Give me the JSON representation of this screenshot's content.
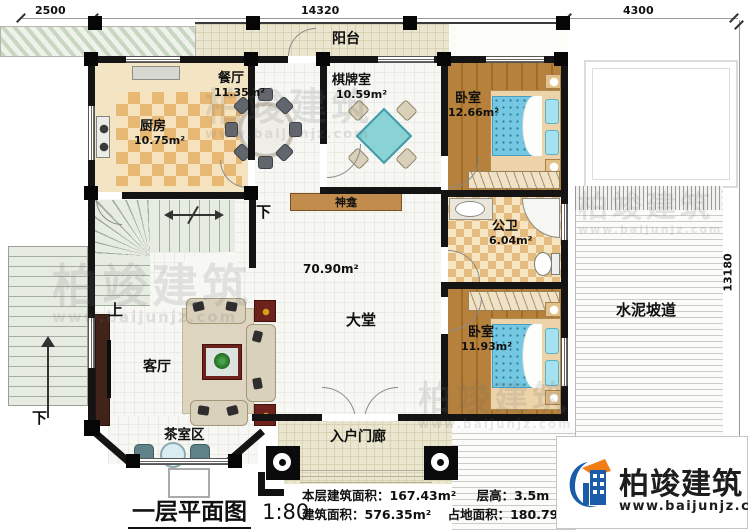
{
  "title_block": {
    "title": "一层平面图",
    "scale": "1:80"
  },
  "stats": {
    "floor_area": "本层建筑面积：167.43m²",
    "floor_height": "层高：3.5m",
    "total_area": "建筑面积：576.35m²",
    "footprint": "占地面积：180.79m²"
  },
  "dimensions": {
    "top_left": "2500",
    "top_middle": "14320",
    "top_right": "4300",
    "right_side": "13180"
  },
  "rooms": {
    "balcony": {
      "name": "阳台"
    },
    "kitchen": {
      "name": "厨房",
      "area": "10.75m²"
    },
    "dining": {
      "name": "餐厅",
      "area": "11.35m²"
    },
    "chess": {
      "name": "棋牌室",
      "area": "10.59m²"
    },
    "bedroom1": {
      "name": "卧室",
      "area": "12.66m²"
    },
    "bathroom": {
      "name": "公卫",
      "area": "6.04m²"
    },
    "bedroom2": {
      "name": "卧室",
      "area": "11.93m²"
    },
    "hall": {
      "name": "大堂",
      "area": "70.90m²"
    },
    "living": {
      "name": "客厅"
    },
    "tea": {
      "name": "茶室区"
    },
    "porch": {
      "name": "入户门廊"
    },
    "shrine": {
      "name": "神龛"
    },
    "ramp": {
      "name": "水泥坡道"
    }
  },
  "stairs": {
    "up": "上",
    "down": "下"
  },
  "brand": {
    "name": "柏竣建筑",
    "url": "www.baijunjz.com"
  },
  "watermark": {
    "text": "柏竣建筑",
    "url": "www.baijunjz.com"
  },
  "colors": {
    "wall": "#141414",
    "wood_floor": "#b5813d",
    "kitchen_tile": "#e7b975",
    "bed_blue": "#74c8e2",
    "chess_table": "#8ad2d6",
    "brand_blue": "#1a5ca8",
    "brand_orange": "#f07d16"
  }
}
